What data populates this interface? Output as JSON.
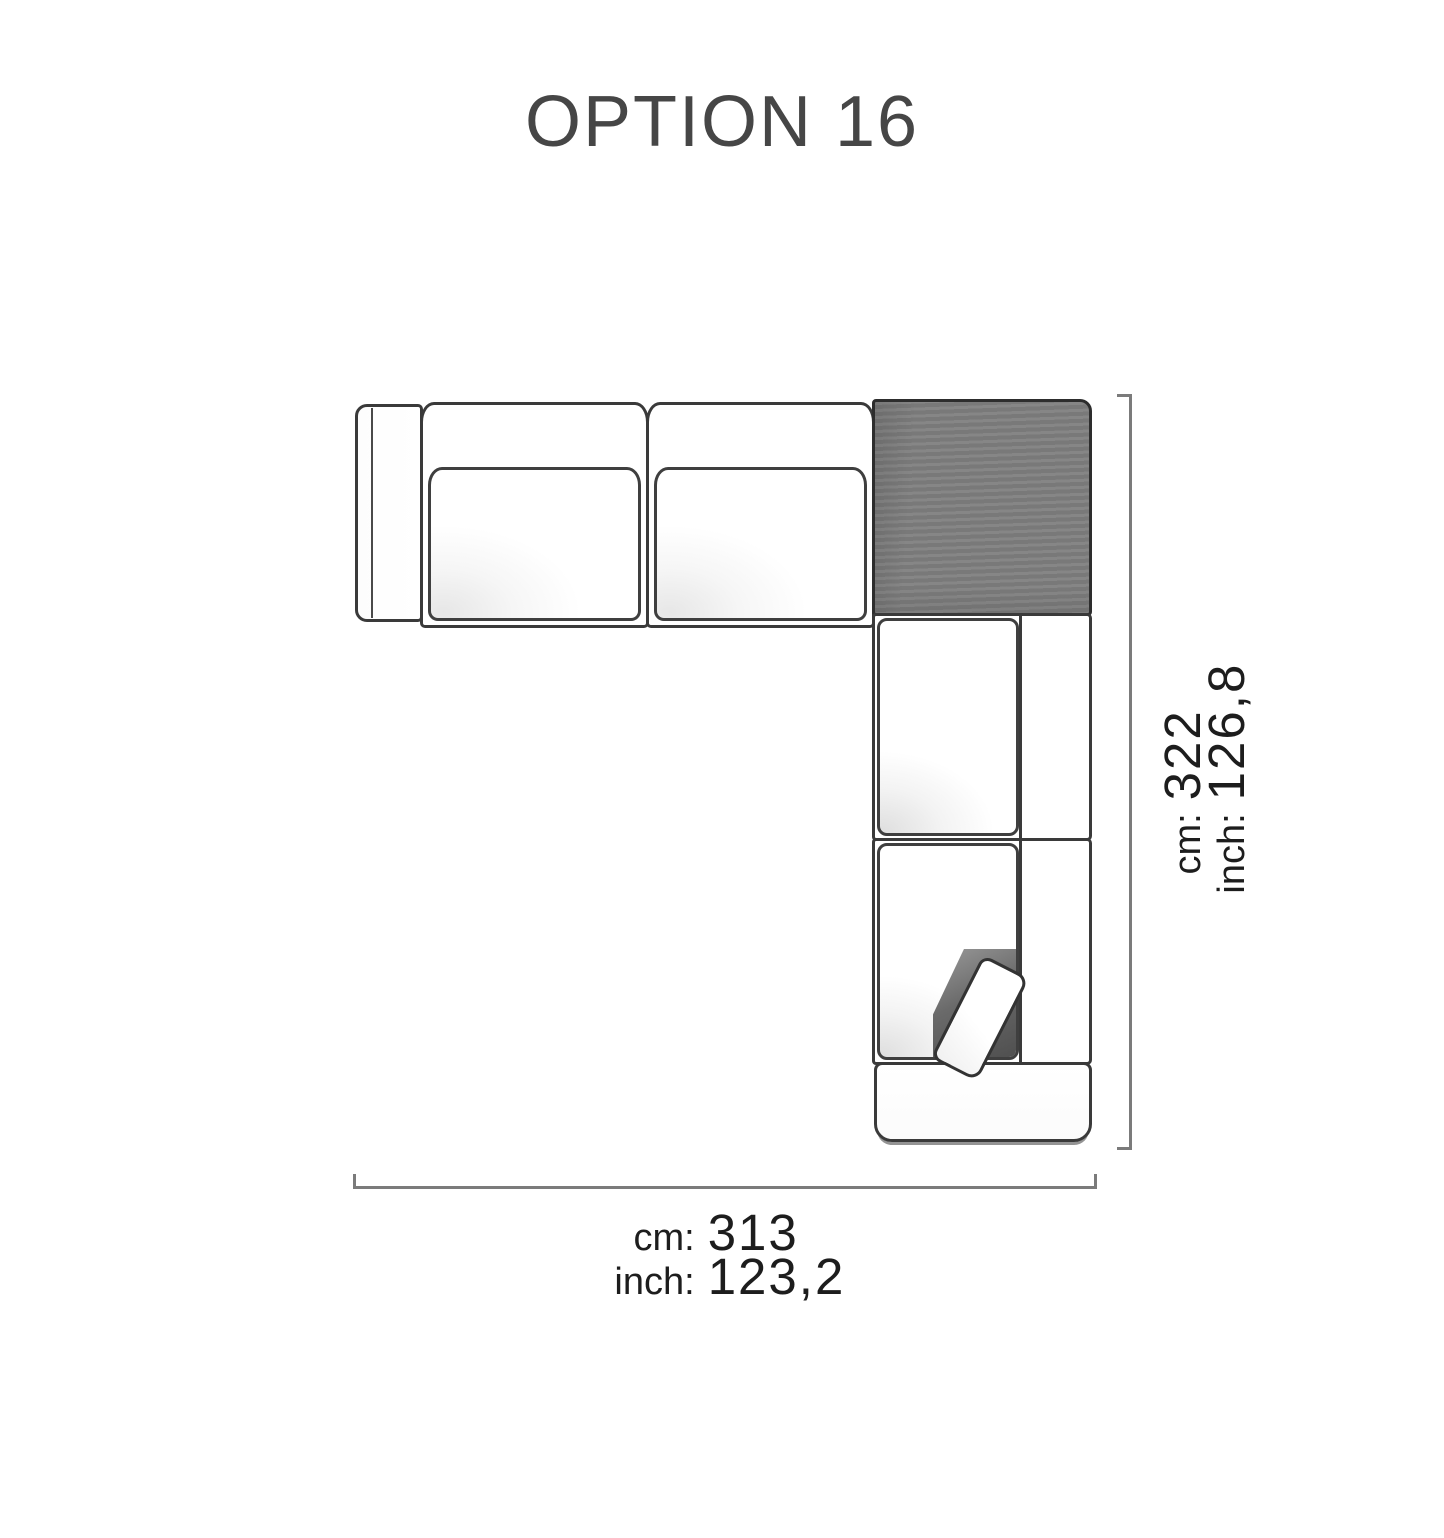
{
  "title": "OPTION 16",
  "dimensions": {
    "height": {
      "cm_label": "cm:",
      "cm_value": "322",
      "inch_label": "inch:",
      "inch_value": "126,8"
    },
    "width": {
      "cm_label": "cm:",
      "cm_value": "313",
      "inch_label": "inch:",
      "inch_value": "123,2"
    }
  },
  "diagram": {
    "type": "sofa-floorplan-top-view",
    "shape": "L-shaped sectional",
    "modules": [
      "left-armrest",
      "seat-module-1",
      "seat-module-2",
      "corner-module-highlighted",
      "seat-module-3",
      "seat-module-4",
      "bottom-armrest",
      "pillow"
    ],
    "corner_highlighted": true
  },
  "colors": {
    "background": "#ffffff",
    "title_text": "#464646",
    "dimension_text": "#1d1d1d",
    "dimension_line": "#7b7b7b",
    "sofa_outline": "#3a3a3a",
    "corner_fill": "#7f7f7f"
  }
}
